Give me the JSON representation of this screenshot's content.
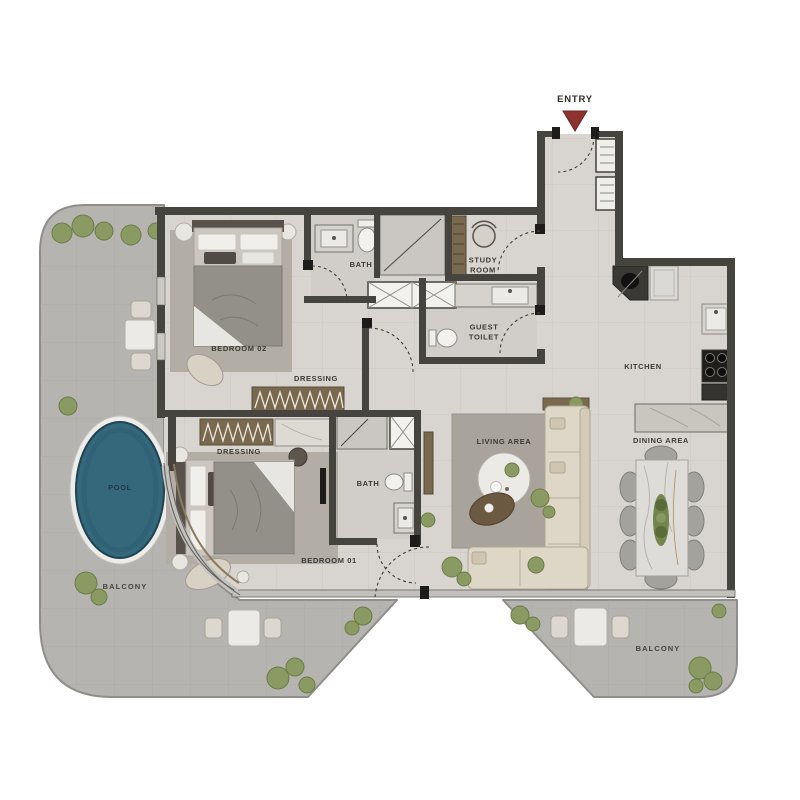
{
  "plan": {
    "entry": {
      "label": "ENTRY"
    },
    "labels": {
      "bedroom_02": "BEDROOM 02",
      "bedroom_01": "BEDROOM 01",
      "bath_main": "BATH",
      "bath_master": "BATH",
      "study_room": "STUDY ROOM",
      "guest_toilet": "GUEST TOILET",
      "kitchen": "KITCHEN",
      "dining_area": "DINING AREA",
      "living_area": "LIVING AREA",
      "dressing_bedroom_02": "DRESSING",
      "dressing_bedroom_01": "DRESSING",
      "pool": "POOL",
      "balcony_left": "BALCONY",
      "balcony_right": "BALCONY"
    },
    "colors": {
      "wall": "#45443f",
      "interior_floor": "#d8d5d0",
      "balcony_floor": "#b6b4b0",
      "pool_water": "#36687c",
      "entry_marker": "#8e3230",
      "label_text": "#3b3a35",
      "wood": "#78694f",
      "greenery": "#8b9a63",
      "sofa": "#ded6c6",
      "marble": "#eceae6",
      "rug": "#b2aea5"
    }
  }
}
